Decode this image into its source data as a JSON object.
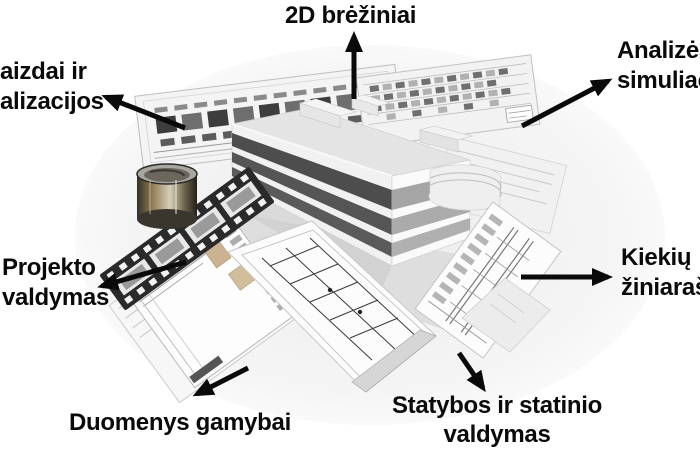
{
  "labels": {
    "drawings2d": "2D brėžiniai",
    "visualizations": {
      "line1": "aizdai ir",
      "line2": "alizacijos"
    },
    "analysis": {
      "line1": "Analizės",
      "line2": "simuliac"
    },
    "project": {
      "line1": "Projekto",
      "line2": "valdymas"
    },
    "quantities": {
      "line1": "Kiekių",
      "line2": "žiniaraš"
    },
    "manufacturing": "Duomenys gamybai",
    "construction": {
      "line1": "Statybos ir statinio",
      "line2": "valdymas"
    }
  },
  "colors": {
    "text": "#0a0a0a",
    "arrow": "#0a0a0a",
    "background": "#ffffff",
    "photo_wash": "#efefef",
    "window_band_dark": "#4d4d4d",
    "sheet_grey": "#f2f2f2",
    "cylinder_brown": "#8f7b52"
  },
  "illustration": {
    "central_object": "bim-3d-building-model",
    "elements": [
      "elevation-drawing-left",
      "elevation-drawing-right",
      "floor-plan-sheets",
      "detail-drawing-sheet",
      "document-sheets",
      "film-strip",
      "render-cylinder"
    ]
  }
}
